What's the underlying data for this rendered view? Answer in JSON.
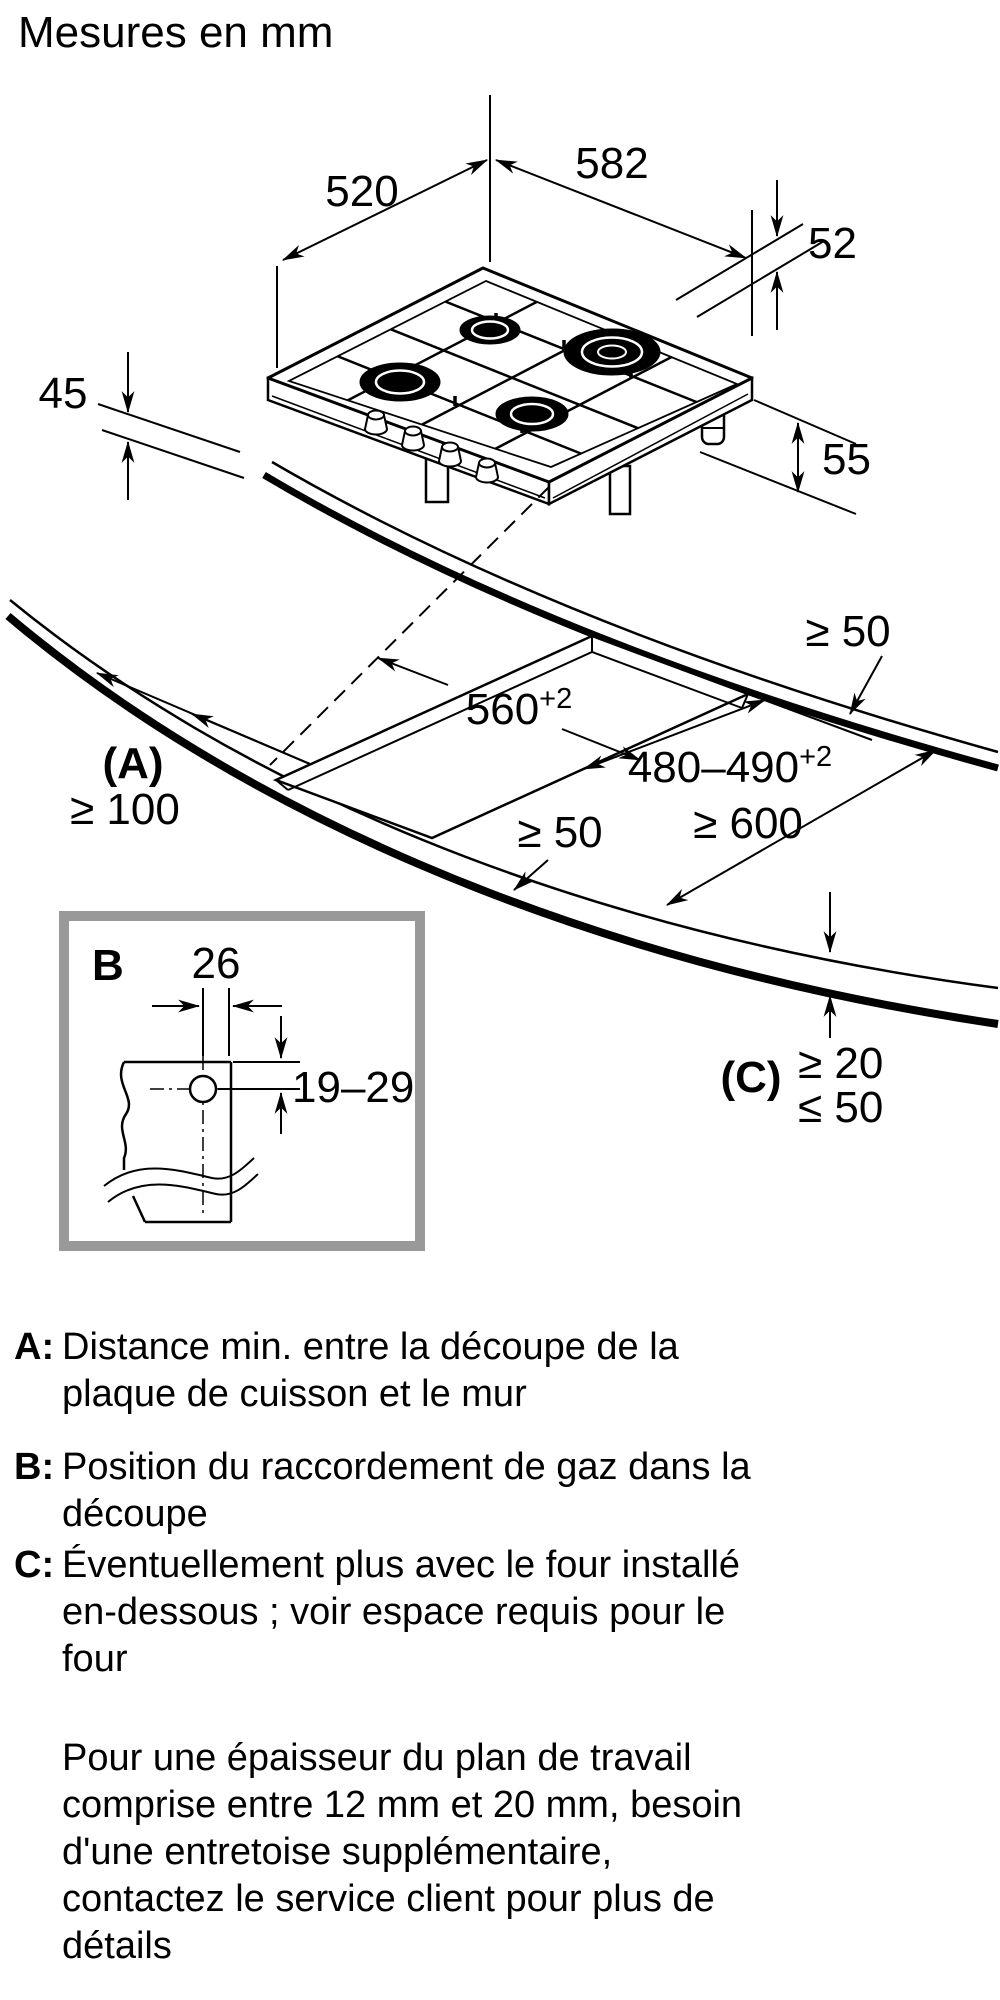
{
  "title": "Mesures en mm",
  "dims": {
    "depth_top": "520",
    "width_top": "582",
    "rim_right": "52",
    "height_left": "45",
    "height_right": "55",
    "cutout_width": "560",
    "cutout_width_tol": "+2",
    "cutout_depth": "480–490",
    "cutout_depth_tol": "+2",
    "wall_clearance_back": "≥ 50",
    "label_a": "(A)",
    "wall_clearance_left": "≥ 100",
    "worktop_depth_min": "≥ 600",
    "front_clearance": "≥ 50",
    "label_c": "(C)",
    "front_edge_min": "≥ 20",
    "front_edge_max": "≤ 50"
  },
  "detail_b": {
    "label": "B",
    "offset": "26",
    "range": "19–29"
  },
  "legend": {
    "items": [
      {
        "label": "A:",
        "lines": [
          "Distance min. entre la découpe de la",
          "plaque de cuisson et le mur"
        ]
      },
      {
        "label": "B:",
        "lines": [
          "Position du raccordement de gaz dans la",
          "découpe"
        ]
      },
      {
        "label": "C:",
        "lines": [
          "Éventuellement plus avec le four installé",
          "en-dessous ; voir espace requis pour le",
          "four"
        ]
      }
    ],
    "note_lines": [
      "Pour une épaisseur du plan de travail",
      "comprise entre 12 mm et 20 mm, besoin",
      "d'une entretoise supplémentaire,",
      "contactez le service client pour plus de",
      "détails"
    ]
  }
}
